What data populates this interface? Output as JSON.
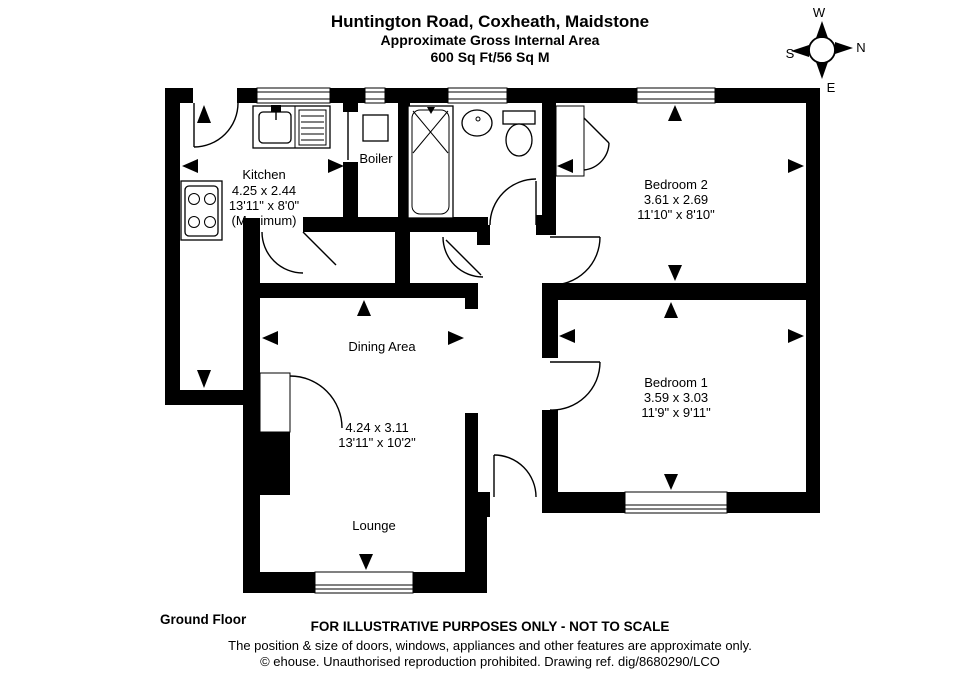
{
  "title": {
    "address": "Huntington Road, Coxheath, Maidstone",
    "subtitle": "Approximate Gross Internal Area",
    "area": "600 Sq Ft/56 Sq M"
  },
  "compass": {
    "top": "W",
    "right": "N",
    "left": "S",
    "bottom": "E"
  },
  "rooms": {
    "kitchen": {
      "name": "Kitchen",
      "metric": "4.25 x 2.44",
      "imperial": "13'11\" x 8'0\"",
      "note": "(Maximum)"
    },
    "boiler": {
      "name": "Boiler"
    },
    "bedroom2": {
      "name": "Bedroom 2",
      "metric": "3.61 x 2.69",
      "imperial": "11'10\" x 8'10\""
    },
    "dining": {
      "name": "Dining Area"
    },
    "lounge": {
      "name": "Lounge",
      "metric": "4.24 x 3.11",
      "imperial": "13'11\" x 10'2\""
    },
    "bedroom1": {
      "name": "Bedroom 1",
      "metric": "3.59 x 3.03",
      "imperial": "11'9\" x 9'11\""
    }
  },
  "footer": {
    "floor": "Ground Floor",
    "notice": "FOR ILLUSTRATIVE PURPOSES ONLY - NOT TO SCALE",
    "disclaimer": "The position & size of doors, windows, appliances and other features are approximate only.",
    "copyright": "© ehouse. Unauthorised reproduction prohibited. Drawing ref. dig/8680290/LCO"
  }
}
